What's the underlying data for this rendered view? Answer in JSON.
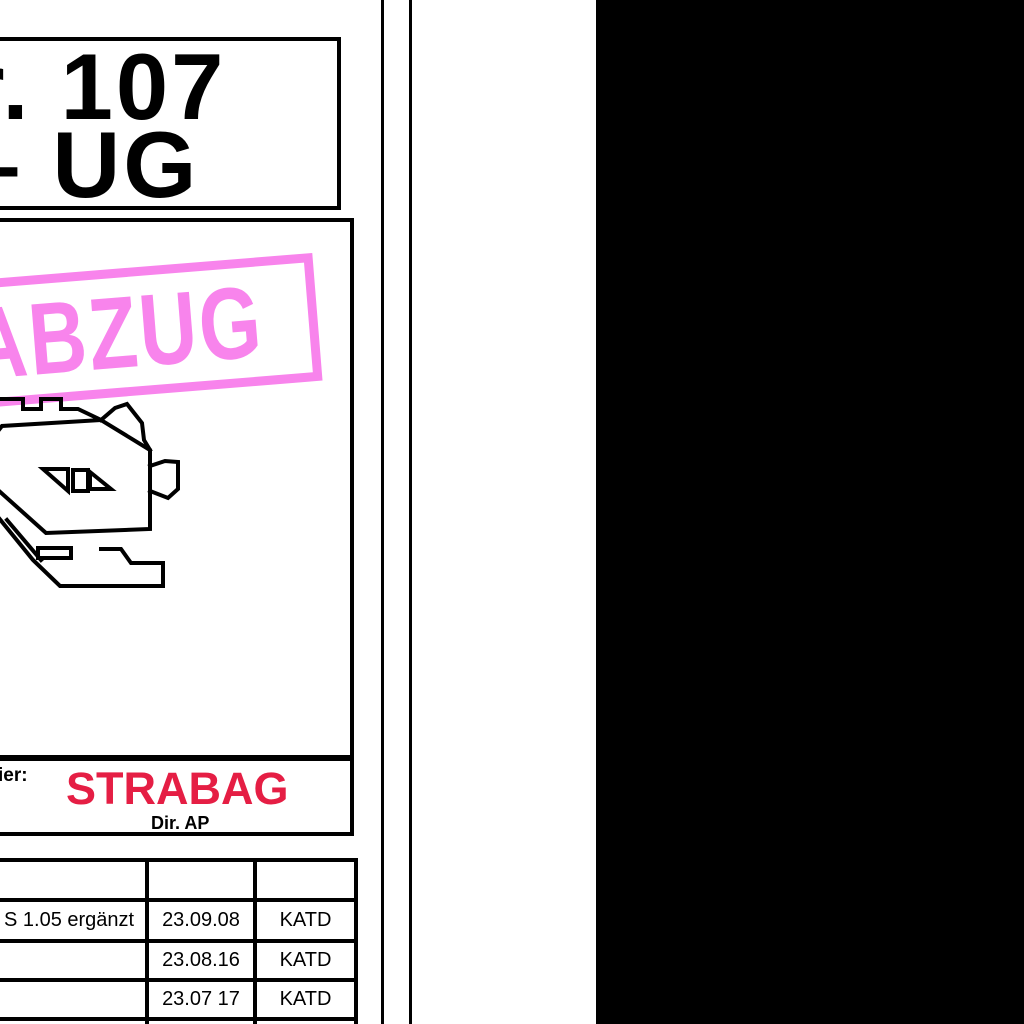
{
  "title_box": {
    "line1": "r. 107",
    "line2": "– UG"
  },
  "stamp": {
    "text": "ABZUG",
    "color": "#f884ec"
  },
  "publisher": {
    "left_label": "ier:",
    "logo_text": "STRABAG",
    "logo_color": "#e51e44",
    "sub_label": "Dir. AP"
  },
  "revision_table": {
    "rows": [
      {
        "description": "",
        "date": "",
        "author": ""
      },
      {
        "description": "S 1.05 ergänzt",
        "date": "23.09.08",
        "author": "KATD"
      },
      {
        "description": "",
        "date": "23.08.16",
        "author": "KATD"
      },
      {
        "description": "",
        "date": "23.07 17",
        "author": "KATD"
      },
      {
        "description": "",
        "date": "",
        "author": ""
      }
    ]
  }
}
